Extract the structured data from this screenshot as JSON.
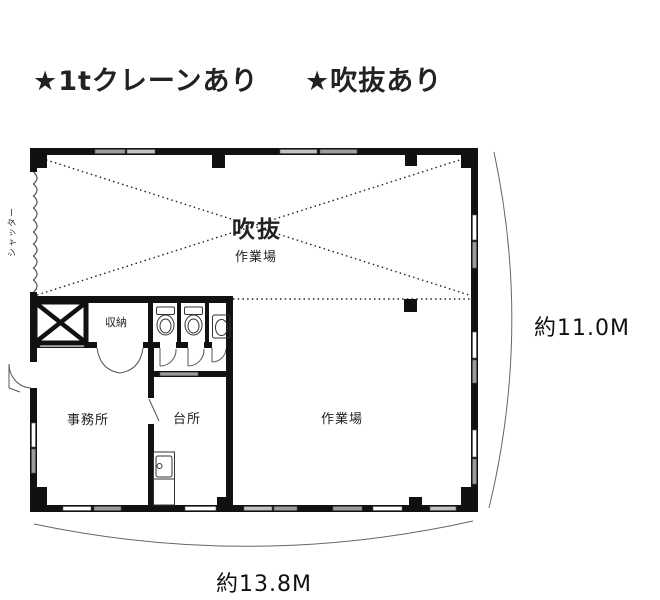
{
  "header": {
    "crane_note": "★1tクレーンあり",
    "void_note": "★吹抜あり"
  },
  "plan": {
    "labels": {
      "void": "吹抜",
      "void_area": "作業場",
      "storage": "収納",
      "office": "事務所",
      "kitchen": "台所",
      "workshop": "作業場",
      "shutter": "シャッター"
    },
    "dimensions": {
      "width": "約13.8M",
      "height": "約11.0M"
    }
  },
  "colors": {
    "accent_red": "#e4150f",
    "wall": "#111111",
    "window_gray": "#9c9c9c",
    "window_light": "#c2c2c2",
    "dim_line": "#666666"
  }
}
